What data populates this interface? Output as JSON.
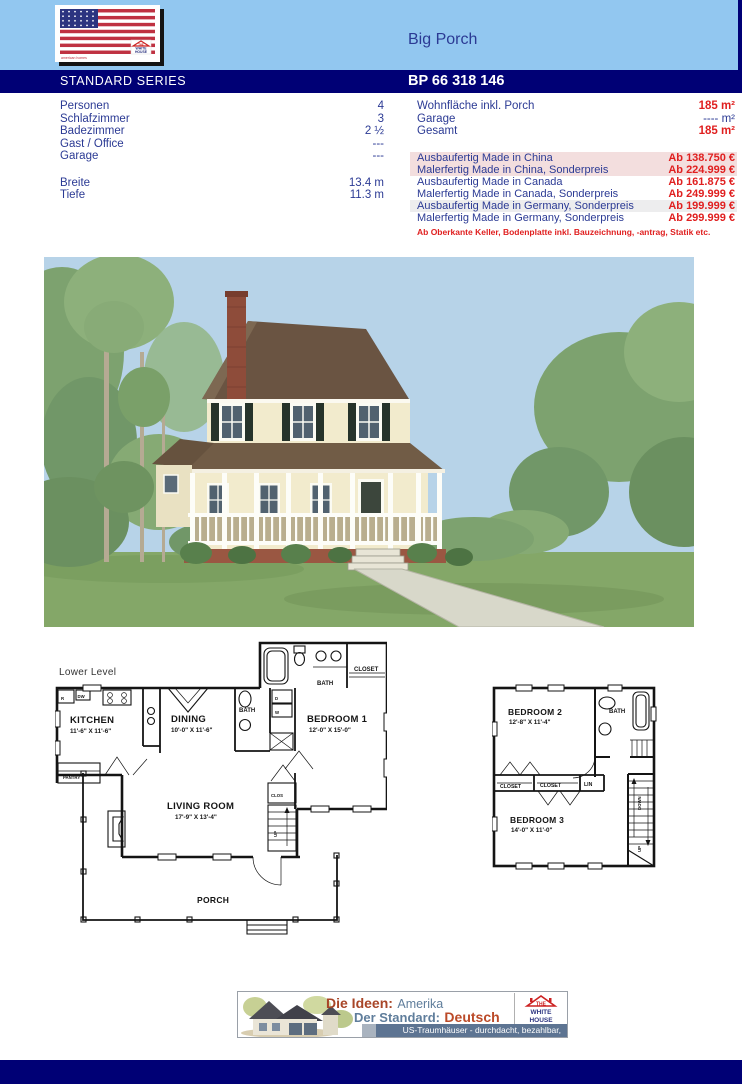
{
  "header": {
    "title": "Big Porch",
    "series_label": "STANDARD SERIES",
    "model_number": "BP 66 318 146",
    "flag_logo": {
      "brand": "american homes",
      "emblem_line1": "THE",
      "emblem_line2": "WHITE",
      "emblem_line3": "HOUSE"
    }
  },
  "specs": {
    "left": [
      {
        "label": "Personen",
        "value": "4"
      },
      {
        "label": "Schlafzimmer",
        "value": "3"
      },
      {
        "label": "Badezimmer",
        "value": "2 ½"
      },
      {
        "label": "Gast / Office",
        "value": "---"
      },
      {
        "label": "Garage",
        "value": "---"
      }
    ],
    "dimensions": [
      {
        "label": "Breite",
        "value": "13.4 m"
      },
      {
        "label": "Tiefe",
        "value": "11.3 m"
      }
    ],
    "areas": [
      {
        "label": "Wohnfläche inkl. Porch",
        "value": "185 m²"
      },
      {
        "label": "Garage",
        "value": "---- m²"
      },
      {
        "label": "Gesamt",
        "value": "185 m²"
      }
    ],
    "prices": [
      {
        "label": "Ausbaufertig Made in China",
        "value": "Ab 138.750 €"
      },
      {
        "label": "Malerfertig Made in China, Sonderpreis",
        "value": "Ab 224.999 €"
      },
      {
        "label": "Ausbaufertig Made in Canada",
        "value": "Ab 161.875 €"
      },
      {
        "label": "Malerfertig Made in Canada, Sonderpreis",
        "value": "Ab 249.999 €"
      },
      {
        "label": "Ausbaufertig Made in Germany, Sonderpreis",
        "value": "Ab 199.999 €"
      },
      {
        "label": "Malerfertig Made in Germany, Sonderpreis",
        "value": "Ab 299.999 €"
      }
    ],
    "note": "Ab Oberkante Keller, Bodenplatte inkl. Bauzeichnung, -antrag, Statik etc."
  },
  "floorplan_lower": {
    "level_label": "Lower Level",
    "kitchen": {
      "name": "KITCHEN",
      "dims": "11'-6\" X 11'-6\""
    },
    "dining": {
      "name": "DINING",
      "dims": "10'-0\" X 11'-6\""
    },
    "bath_upper": "BATH",
    "bath_mid": "BATH",
    "closet": "CLOSET",
    "bedroom1": {
      "name": "BEDROOM 1",
      "dims": "12'-0\" X 15'-0\""
    },
    "pantry": "PANTRY",
    "living": {
      "name": "LIVING ROOM",
      "dims": "17'-9\" X 13'-4\""
    },
    "clos": "CLOS",
    "porch": "PORCH",
    "up": "UP",
    "appliances": {
      "r": "R",
      "dw": "DW",
      "d": "D",
      "w": "W"
    }
  },
  "floorplan_upper": {
    "bedroom2": {
      "name": "BEDROOM 2",
      "dims": "12'-8\" X 11'-4\""
    },
    "bath": "BATH",
    "closet1": "CLOSET",
    "closet2": "CLOSET",
    "lin": "LIN",
    "bedroom3": {
      "name": "BEDROOM 3",
      "dims": "14'-0\" X 11'-0\""
    },
    "down": "DOWN",
    "up": "UP"
  },
  "banner": {
    "idea_label": "Die Ideen:",
    "idea_value": "Amerika",
    "standard_label": "Der Standard:",
    "standard_value": "Deutsch",
    "tagline": "US-Traumhäuser - durchdacht, bezahlbar, variabel",
    "logo": {
      "line1": "THE",
      "line2": "WHITE",
      "line3": "HOUSE"
    }
  },
  "colors": {
    "header_blue": "#92c7f0",
    "navy": "#000075",
    "text_navy": "#2b3a94",
    "price_red": "#e02020",
    "row_pink": "#f3dede",
    "row_gray": "#ededee"
  }
}
